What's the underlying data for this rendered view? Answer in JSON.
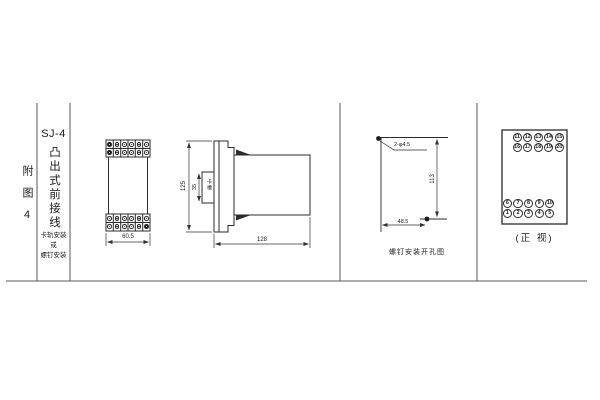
{
  "figure": {
    "fig_label": "附图4",
    "model": "SJ-4",
    "type_label": "凸出式前接线",
    "mount_note_lines": [
      "卡轨安装",
      "或",
      "螺钉安装"
    ]
  },
  "front_view": {
    "width_dim": "60.5",
    "columns": 6,
    "rows": 2,
    "top_filled": [
      [
        0,
        0
      ],
      [
        1,
        0
      ]
    ],
    "bottom_filled": [
      [
        1,
        5
      ]
    ]
  },
  "side_view": {
    "height_dim": "125",
    "depth_dim": "128",
    "notch_dim": "35",
    "notch_label": "卡槽"
  },
  "drill_view": {
    "hole_label": "2-φ4.5",
    "vertical_dim": "113",
    "horizontal_dim": "48.5",
    "caption": "螺钉安装开孔图"
  },
  "terminal_view": {
    "caption": "(正 视)",
    "top_rows": [
      [
        "11",
        "12",
        "13",
        "14",
        "15"
      ],
      [
        "16",
        "17",
        "18",
        "19",
        "20"
      ]
    ],
    "bottom_rows": [
      [
        "6",
        "7",
        "8",
        "9",
        "10"
      ],
      [
        "1",
        "2",
        "3",
        "4",
        "5"
      ]
    ]
  }
}
